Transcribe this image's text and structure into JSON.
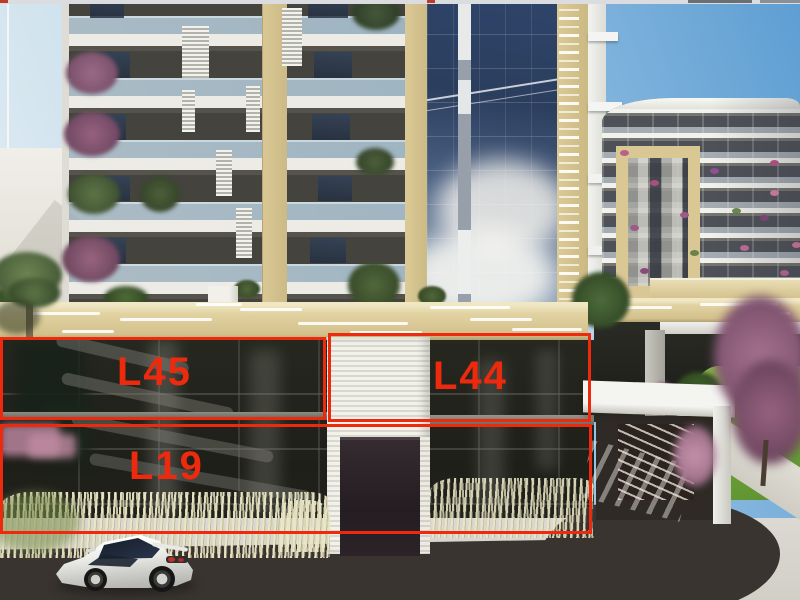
{
  "image": {
    "type": "architectural-rendering",
    "description": "3D exterior rendering of a modern apartment complex with red overlay rectangles marking retail/unit spaces on the lower floors"
  },
  "annotations": {
    "accent_color": "#ee2a0e",
    "units": [
      {
        "id": "L45",
        "label": "L45"
      },
      {
        "id": "L44",
        "label": "L44"
      },
      {
        "id": "L19",
        "label": "L19"
      }
    ]
  },
  "palette": {
    "sky_blue": "#5e9ed3",
    "canopy_tan": "#e2d3a2",
    "curtain_wall_blue": "#2c4063",
    "storefront_glass": "#22231e",
    "asphalt": "#3a3430",
    "lawn_green": "#7cab3e",
    "car_body": "#e9e9e6"
  }
}
